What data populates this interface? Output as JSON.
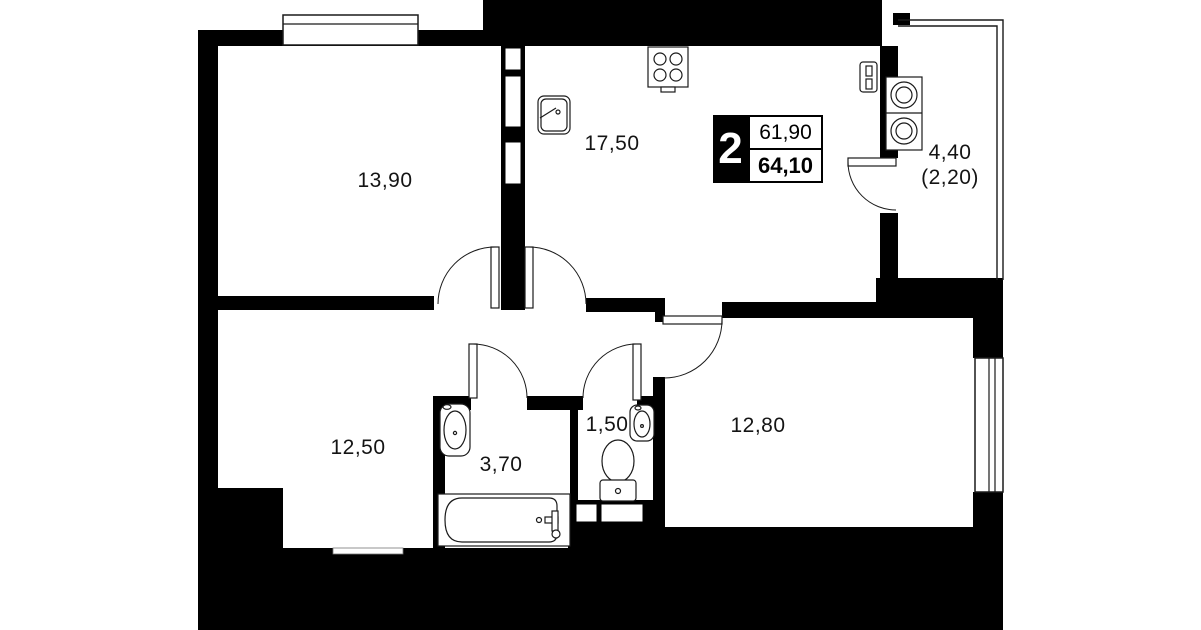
{
  "plan": {
    "title": "2-room apartment floor plan",
    "badge": {
      "rooms_count": "2",
      "living_area": "61,90",
      "total_area": "64,10"
    },
    "rooms": [
      {
        "id": "bedroom-1",
        "area": "13,90"
      },
      {
        "id": "kitchen-living",
        "area": "17,50"
      },
      {
        "id": "hallway",
        "area": "12,50"
      },
      {
        "id": "bathroom",
        "area": "3,70"
      },
      {
        "id": "wc",
        "area": "1,50"
      },
      {
        "id": "bedroom-2",
        "area": "12,80"
      },
      {
        "id": "balcony",
        "area": "4,40",
        "area_with_coefficient": "(2,20)"
      }
    ],
    "fixtures": [
      "stove-icon",
      "kitchen-sink-icon",
      "electrical-panel-icon",
      "washer-stack-icon",
      "bathtub-icon",
      "bathroom-sink-icon",
      "wc-sink-icon",
      "toilet-icon",
      "window-icon",
      "door-swing-icon",
      "entry-threshold-icon",
      "shaft-niche-icon"
    ],
    "colors": {
      "walls": "#000000",
      "background": "#ffffff",
      "fixture_line": "#1a1a1a"
    }
  }
}
